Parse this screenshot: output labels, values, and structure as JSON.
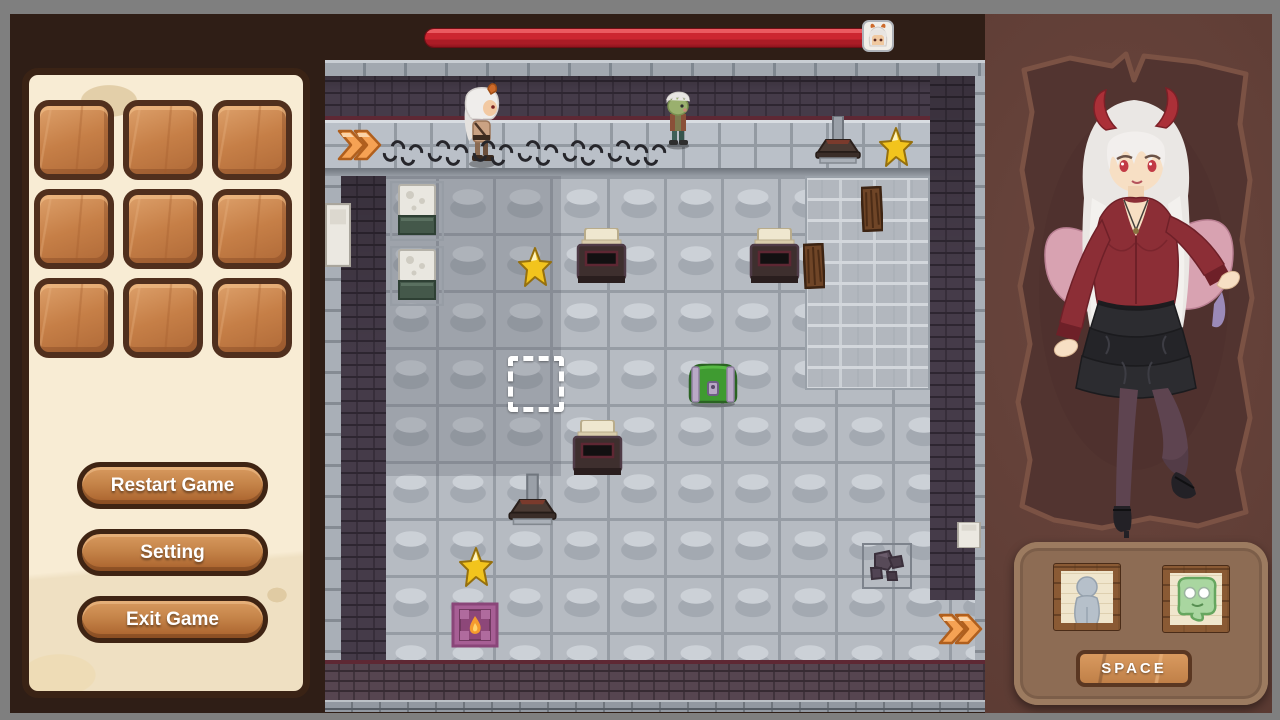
{
  "menu": {
    "slot_count": 9,
    "buttons": [
      {
        "id": "restart",
        "label": "Restart Game"
      },
      {
        "id": "setting",
        "label": "Setting"
      },
      {
        "id": "exit",
        "label": "Exit Game"
      }
    ]
  },
  "hud": {
    "health_bar": {
      "percent": 100,
      "fill_color": "#cc2630"
    },
    "avatar_icon": "player-face-icon"
  },
  "party": {
    "portraits": [
      {
        "id": "gray-figure",
        "icon": "gray-figure-icon"
      },
      {
        "id": "green-blob",
        "icon": "green-blob-icon"
      }
    ],
    "action_button": {
      "label": "SPACE"
    }
  },
  "game": {
    "objects": [
      {
        "type": "arrow",
        "name": "map-arrow-left",
        "x": 11,
        "y": 66,
        "w": 46,
        "h": 38,
        "interactable": true
      },
      {
        "type": "press",
        "name": "trap-press-1",
        "x": 487,
        "y": 56,
        "w": 52,
        "h": 48,
        "interactable": false
      },
      {
        "type": "star",
        "name": "star-1",
        "x": 553,
        "y": 66,
        "w": 36,
        "h": 44,
        "interactable": true
      },
      {
        "type": "machine",
        "name": "machine-1",
        "x": 65,
        "y": 121,
        "w": 54,
        "h": 60,
        "interactable": false
      },
      {
        "type": "machine",
        "name": "machine-2",
        "x": 65,
        "y": 186,
        "w": 54,
        "h": 60,
        "interactable": false
      },
      {
        "type": "star",
        "name": "star-2",
        "x": 192,
        "y": 186,
        "w": 36,
        "h": 44,
        "interactable": true
      },
      {
        "type": "furnace",
        "name": "furnace-1",
        "x": 248,
        "y": 168,
        "w": 57,
        "h": 60,
        "interactable": false
      },
      {
        "type": "furnace",
        "name": "furnace-2",
        "x": 421,
        "y": 168,
        "w": 57,
        "h": 60,
        "interactable": false
      },
      {
        "type": "hatch",
        "name": "wood-hatch-1",
        "x": 536,
        "y": 126,
        "w": 22,
        "h": 46,
        "interactable": false
      },
      {
        "type": "hatch",
        "name": "wood-hatch-2",
        "x": 478,
        "y": 183,
        "w": 22,
        "h": 46,
        "interactable": false
      },
      {
        "type": "selection",
        "name": "selection-cursor",
        "x": 183,
        "y": 296,
        "w": 56,
        "h": 56,
        "interactable": true
      },
      {
        "type": "chest",
        "name": "green-chest",
        "x": 362,
        "y": 298,
        "w": 52,
        "h": 50,
        "interactable": true
      },
      {
        "type": "furnace",
        "name": "furnace-3",
        "x": 244,
        "y": 360,
        "w": 57,
        "h": 60,
        "interactable": false
      },
      {
        "type": "press",
        "name": "trap-press-2",
        "x": 180,
        "y": 412,
        "w": 55,
        "h": 56,
        "interactable": false
      },
      {
        "type": "star",
        "name": "star-3",
        "x": 133,
        "y": 486,
        "w": 36,
        "h": 44,
        "interactable": true
      },
      {
        "type": "flame",
        "name": "flame-tile",
        "x": 126,
        "y": 542,
        "w": 48,
        "h": 46,
        "interactable": false
      },
      {
        "type": "rocks",
        "name": "rock-pile",
        "x": 536,
        "y": 482,
        "w": 52,
        "h": 48,
        "interactable": false
      },
      {
        "type": "arrow",
        "name": "map-arrow-right",
        "x": 612,
        "y": 550,
        "w": 46,
        "h": 38,
        "interactable": true
      },
      {
        "type": "whitebox",
        "name": "wall-block-left",
        "x": 0,
        "y": 143,
        "w": 26,
        "h": 64,
        "interactable": false
      },
      {
        "type": "whitebox",
        "name": "wall-block-right",
        "x": 632,
        "y": 462,
        "w": 24,
        "h": 26,
        "interactable": false
      },
      {
        "type": "player",
        "name": "player-character",
        "x": 135,
        "y": 23,
        "w": 42,
        "h": 86,
        "interactable": false
      },
      {
        "type": "zombie",
        "name": "zombie-enemy",
        "x": 336,
        "y": 28,
        "w": 34,
        "h": 62,
        "interactable": false
      }
    ],
    "footprints": [
      {
        "x": 58,
        "y": 80
      },
      {
        "x": 76,
        "y": 84
      },
      {
        "x": 103,
        "y": 80
      },
      {
        "x": 121,
        "y": 84
      },
      {
        "x": 148,
        "y": 80
      },
      {
        "x": 166,
        "y": 84
      },
      {
        "x": 193,
        "y": 80
      },
      {
        "x": 211,
        "y": 84
      },
      {
        "x": 238,
        "y": 80
      },
      {
        "x": 256,
        "y": 84
      },
      {
        "x": 283,
        "y": 80
      },
      {
        "x": 301,
        "y": 84
      },
      {
        "x": 319,
        "y": 84
      }
    ]
  },
  "colors": {
    "screen_bg": "#7f7f7f",
    "frame_brown": "#2f1e16",
    "panel_cream": "#f8ecd4",
    "wood_brown": "#c58449",
    "health_red": "#cc2630",
    "accent_orange": "#f59d4a",
    "floor_gray": "#b6bbc2",
    "wall_dark": "#453b49",
    "parchment_brown": "#523430",
    "hud_brown": "#8d6c54"
  }
}
